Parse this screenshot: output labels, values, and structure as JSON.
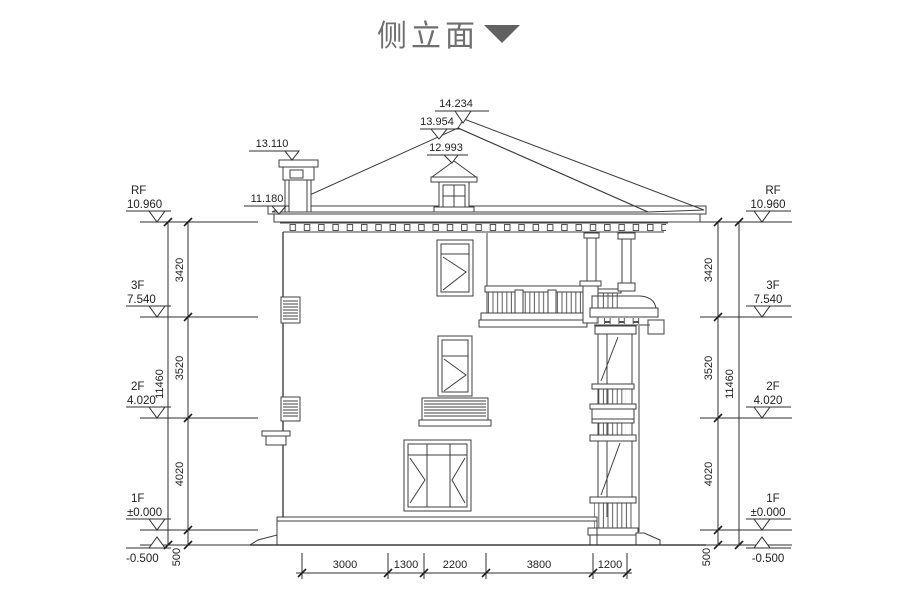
{
  "title": {
    "text": "侧立面"
  },
  "markers": {
    "ridge_top": "14.234",
    "ridge_hip": "13.954",
    "dormer_ridge": "12.993",
    "chimney_top": "13.110",
    "eave": "11.180"
  },
  "levels": {
    "rf": {
      "name": "RF",
      "elev": "10.960"
    },
    "f3": {
      "name": "3F",
      "elev": "7.540"
    },
    "f2": {
      "name": "2F",
      "elev": "4.020"
    },
    "f1": {
      "name": "1F",
      "elev": "±0.000"
    },
    "ground": {
      "elev": "-0.500"
    }
  },
  "vdims": {
    "rf_3f": "3420",
    "f3_f2": "3520",
    "f2_f1": "4020",
    "f1_gnd": "500",
    "total": "11460"
  },
  "hdims": [
    "3000",
    "1300",
    "2200",
    "3800",
    "1200"
  ]
}
